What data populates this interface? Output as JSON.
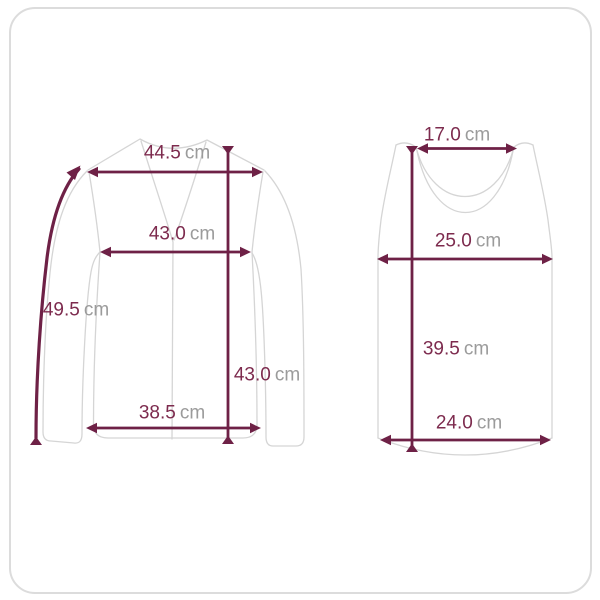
{
  "colors": {
    "background": "#ffffff",
    "border": "#dcdcdc",
    "outline": "#d5d5d5",
    "accent": "#6e2146",
    "value_text": "#7d2b4e",
    "unit_text": "#9b9b9b"
  },
  "garments": {
    "cardigan": {
      "name": "long-sleeve v-neck cardigan",
      "measurements": {
        "shoulder": {
          "value": "44.5",
          "unit": "cm"
        },
        "chest": {
          "value": "43.0",
          "unit": "cm"
        },
        "sleeve": {
          "value": "49.5",
          "unit": "cm"
        },
        "length": {
          "value": "43.0",
          "unit": "cm"
        },
        "hem": {
          "value": "38.5",
          "unit": "cm"
        }
      }
    },
    "tank_top": {
      "name": "sleeveless tank top",
      "measurements": {
        "neck": {
          "value": "17.0",
          "unit": "cm"
        },
        "chest": {
          "value": "25.0",
          "unit": "cm"
        },
        "length": {
          "value": "39.5",
          "unit": "cm"
        },
        "hem": {
          "value": "24.0",
          "unit": "cm"
        }
      }
    }
  }
}
